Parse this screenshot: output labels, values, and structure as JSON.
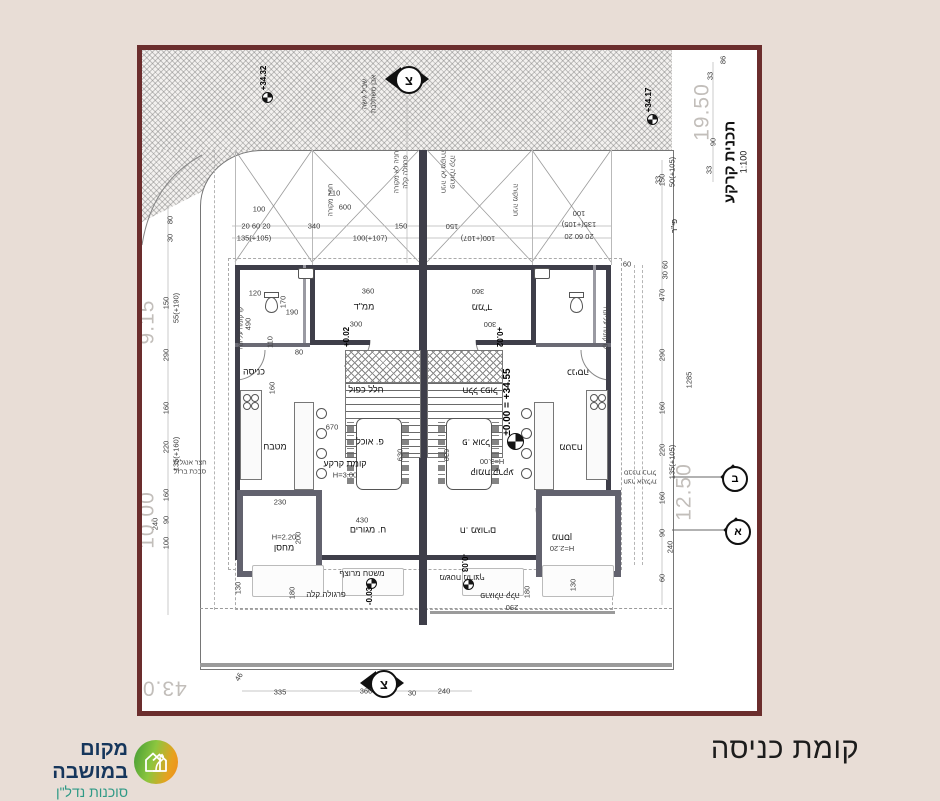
{
  "title": {
    "text": "קומת כניסה"
  },
  "logo": {
    "name": "מקום במושבה",
    "tagline": "סוכנות נדל\"ן",
    "colors": {
      "name": "#16365c",
      "tagline": "#2f9a86",
      "icon_green": "#8cc63f",
      "icon_orange": "#ee8c1e"
    }
  },
  "drawing": {
    "frame_color": "#6b2d2d",
    "plan_title": "תכנית קרקע",
    "plan_scale": "1:100",
    "north_letter": "צ",
    "section_marks": {
      "top": "ב",
      "bottom": "א"
    },
    "labels": [
      {
        "t": "+34.32",
        "x": 122,
        "y": 28,
        "r": -90,
        "c": "lvl"
      },
      {
        "t": "+34.17",
        "x": 507,
        "y": 50,
        "r": -90,
        "c": "lvl"
      },
      {
        "t": "שביל גישה",
        "x": 224,
        "y": 44,
        "r": -90,
        "c": "tiny"
      },
      {
        "t": "אבן משתלבת",
        "x": 233,
        "y": 44,
        "r": -90,
        "c": "tiny"
      },
      {
        "t": "19.50",
        "x": 560,
        "y": 62,
        "r": -90,
        "c": "big"
      },
      {
        "t": "86",
        "x": 581,
        "y": 10,
        "r": -90,
        "c": "dims"
      },
      {
        "t": "33",
        "x": 568,
        "y": 26,
        "r": -90,
        "c": "dims"
      },
      {
        "t": "90",
        "x": 571,
        "y": 92,
        "r": -90,
        "c": "dims"
      },
      {
        "t": "33",
        "x": 567,
        "y": 120,
        "r": -90,
        "c": "dims"
      },
      {
        "t": "33",
        "x": 516,
        "y": 130,
        "r": -90,
        "c": "dims"
      },
      {
        "t": "30 60",
        "x": 523,
        "y": 220,
        "r": -90,
        "c": "dims"
      },
      {
        "t": "פי\"ר",
        "x": 533,
        "y": 176,
        "r": -90,
        "c": "dim"
      },
      {
        "t": "חניה מקורה",
        "x": 190,
        "y": 150,
        "r": -90,
        "c": "tiny"
      },
      {
        "t": "חניה לא מקורה",
        "x": 256,
        "y": 122,
        "r": -90,
        "c": "tiny"
      },
      {
        "t": "פרגולה קלה",
        "x": 265,
        "y": 122,
        "r": -90,
        "c": "tiny"
      },
      {
        "t": "חניה לא מקורה",
        "x": 300,
        "y": 122,
        "r": 90,
        "c": "tiny"
      },
      {
        "t": "פרגולה קלה",
        "x": 309,
        "y": 122,
        "r": 90,
        "c": "tiny"
      },
      {
        "t": "חניה מקורה",
        "x": 372,
        "y": 150,
        "r": 90,
        "c": "tiny"
      },
      {
        "t": "710",
        "x": 192,
        "y": 143,
        "r": 0,
        "c": "dims"
      },
      {
        "t": "600",
        "x": 203,
        "y": 157,
        "r": 0,
        "c": "dims"
      },
      {
        "t": "340",
        "x": 172,
        "y": 176,
        "r": 0,
        "c": "dims"
      },
      {
        "t": "100",
        "x": 117,
        "y": 159,
        "r": 0,
        "c": "dims"
      },
      {
        "t": "20 60 20",
        "x": 114,
        "y": 176,
        "r": 0,
        "c": "dims"
      },
      {
        "t": "135(+105)",
        "x": 112,
        "y": 188,
        "r": 0,
        "c": "dims"
      },
      {
        "t": "100(+107)",
        "x": 228,
        "y": 188,
        "r": 0,
        "c": "dims"
      },
      {
        "t": "150",
        "x": 259,
        "y": 176,
        "r": 0,
        "c": "dims"
      },
      {
        "t": "150",
        "x": 310,
        "y": 176,
        "r": 180,
        "c": "dims"
      },
      {
        "t": "100(+107)",
        "x": 336,
        "y": 188,
        "r": 180,
        "c": "dims"
      },
      {
        "t": "100",
        "x": 437,
        "y": 163,
        "r": 180,
        "c": "dims"
      },
      {
        "t": "135(+105)",
        "x": 437,
        "y": 174,
        "r": 180,
        "c": "dims"
      },
      {
        "t": "20 60 20",
        "x": 437,
        "y": 186,
        "r": 180,
        "c": "dims"
      },
      {
        "t": "60",
        "x": 485,
        "y": 214,
        "r": 0,
        "c": "dims"
      },
      {
        "t": "150",
        "x": 520,
        "y": 130,
        "r": -90,
        "c": "dims"
      },
      {
        "t": "50(+105)",
        "x": 530,
        "y": 122,
        "r": -90,
        "c": "dims"
      },
      {
        "t": "470",
        "x": 520,
        "y": 245,
        "r": -90,
        "c": "dims"
      },
      {
        "t": "290",
        "x": 520,
        "y": 305,
        "r": -90,
        "c": "dims"
      },
      {
        "t": "160",
        "x": 520,
        "y": 358,
        "r": -90,
        "c": "dims"
      },
      {
        "t": "220",
        "x": 520,
        "y": 400,
        "r": -90,
        "c": "dims"
      },
      {
        "t": "135(+105)",
        "x": 530,
        "y": 412,
        "r": -90,
        "c": "dims"
      },
      {
        "t": "160",
        "x": 520,
        "y": 448,
        "r": -90,
        "c": "dims"
      },
      {
        "t": "90",
        "x": 520,
        "y": 483,
        "r": -90,
        "c": "dims"
      },
      {
        "t": "240",
        "x": 528,
        "y": 497,
        "r": -90,
        "c": "dims"
      },
      {
        "t": "60",
        "x": 520,
        "y": 528,
        "r": -90,
        "c": "dims"
      },
      {
        "t": "1285",
        "x": 547,
        "y": 330,
        "r": -90,
        "c": "dims"
      },
      {
        "t": "12.50",
        "x": 542,
        "y": 442,
        "r": -90,
        "c": "big"
      },
      {
        "t": "150",
        "x": 24,
        "y": 253,
        "r": -90,
        "c": "dims"
      },
      {
        "t": "55(+190)",
        "x": 34,
        "y": 258,
        "r": -90,
        "c": "dims"
      },
      {
        "t": "290",
        "x": 24,
        "y": 305,
        "r": -90,
        "c": "dims"
      },
      {
        "t": "160",
        "x": 24,
        "y": 358,
        "r": -90,
        "c": "dims"
      },
      {
        "t": "220",
        "x": 24,
        "y": 397,
        "r": -90,
        "c": "dims"
      },
      {
        "t": "135(+160)",
        "x": 34,
        "y": 404,
        "r": -90,
        "c": "dims"
      },
      {
        "t": "160",
        "x": 24,
        "y": 445,
        "r": -90,
        "c": "dims"
      },
      {
        "t": "90",
        "x": 24,
        "y": 470,
        "r": -90,
        "c": "dims"
      },
      {
        "t": "240",
        "x": 13,
        "y": 474,
        "r": -90,
        "c": "dims"
      },
      {
        "t": "100",
        "x": 24,
        "y": 493,
        "r": -90,
        "c": "dims"
      },
      {
        "t": "9.15",
        "x": 5,
        "y": 272,
        "r": -90,
        "c": "big"
      },
      {
        "t": "10.00",
        "x": 5,
        "y": 470,
        "r": -90,
        "c": "big"
      },
      {
        "t": "80",
        "x": 28,
        "y": 170,
        "r": -90,
        "c": "dims"
      },
      {
        "t": "30",
        "x": 28,
        "y": 188,
        "r": -90,
        "c": "dims"
      },
      {
        "t": "120",
        "x": 113,
        "y": 243,
        "r": 0,
        "c": "dims"
      },
      {
        "t": "490",
        "x": 106,
        "y": 274,
        "r": -90,
        "c": "dims"
      },
      {
        "t": "190",
        "x": 150,
        "y": 262,
        "r": 0,
        "c": "dims"
      },
      {
        "t": "170",
        "x": 141,
        "y": 252,
        "r": -90,
        "c": "dims"
      },
      {
        "t": "110",
        "x": 128,
        "y": 292,
        "r": -90,
        "c": "dims"
      },
      {
        "t": "160",
        "x": 130,
        "y": 338,
        "r": -90,
        "c": "dims"
      },
      {
        "t": "80",
        "x": 157,
        "y": 302,
        "r": 0,
        "c": "dims"
      },
      {
        "t": "360",
        "x": 226,
        "y": 241,
        "r": 0,
        "c": "dims"
      },
      {
        "t": "300",
        "x": 214,
        "y": 274,
        "r": 0,
        "c": "dims"
      },
      {
        "t": "360",
        "x": 336,
        "y": 241,
        "r": 180,
        "c": "dims"
      },
      {
        "t": "300",
        "x": 348,
        "y": 274,
        "r": 180,
        "c": "dims"
      },
      {
        "t": "ממ\"ד",
        "x": 222,
        "y": 257,
        "r": 0,
        "c": "room"
      },
      {
        "t": "ממ\"ד",
        "x": 340,
        "y": 257,
        "r": 180,
        "c": "room"
      },
      {
        "t": "+0.02",
        "x": 205,
        "y": 287,
        "r": -90,
        "c": "lvl"
      },
      {
        "t": "+0.02",
        "x": 357,
        "y": 287,
        "r": 90,
        "c": "lvl"
      },
      {
        "t": "כניסה",
        "x": 112,
        "y": 322,
        "r": 0,
        "c": "room"
      },
      {
        "t": "כניסה",
        "x": 436,
        "y": 322,
        "r": 180,
        "c": "room"
      },
      {
        "t": "קו קומה עליונה",
        "x": 100,
        "y": 278,
        "r": -90,
        "c": "tiny"
      },
      {
        "t": "קו קומה עליונה",
        "x": 462,
        "y": 278,
        "r": 90,
        "c": "tiny"
      },
      {
        "t": "חלל כפול",
        "x": 224,
        "y": 340,
        "r": 0,
        "c": "room"
      },
      {
        "t": "חלל כפול",
        "x": 338,
        "y": 340,
        "r": 180,
        "c": "room"
      },
      {
        "t": "פ. אוכל",
        "x": 228,
        "y": 392,
        "r": 0,
        "c": "room"
      },
      {
        "t": "פ. אוכל",
        "x": 334,
        "y": 392,
        "r": 180,
        "c": "room"
      },
      {
        "t": "670",
        "x": 190,
        "y": 377,
        "r": 0,
        "c": "dims"
      },
      {
        "t": "מטבח",
        "x": 133,
        "y": 397,
        "r": 0,
        "c": "room"
      },
      {
        "t": "מטבח",
        "x": 429,
        "y": 397,
        "r": 180,
        "c": "room"
      },
      {
        "t": "±0.00 = +34.55",
        "x": 366,
        "y": 352,
        "r": -90,
        "c": "lvl2"
      },
      {
        "t": "630",
        "x": 258,
        "y": 405,
        "r": -90,
        "c": "dims"
      },
      {
        "t": "630",
        "x": 304,
        "y": 405,
        "r": 90,
        "c": "dims"
      },
      {
        "t": "קומת קרקע",
        "x": 203,
        "y": 414,
        "r": 0,
        "c": "room"
      },
      {
        "t": "H=3.00",
        "x": 203,
        "y": 425,
        "r": 0,
        "c": "dims"
      },
      {
        "t": "קומת קרקע",
        "x": 350,
        "y": 422,
        "r": 180,
        "c": "room"
      },
      {
        "t": "H=3.00",
        "x": 350,
        "y": 411,
        "r": 180,
        "c": "dims"
      },
      {
        "t": "430",
        "x": 220,
        "y": 470,
        "r": 0,
        "c": "dims"
      },
      {
        "t": "ח. מגורים",
        "x": 226,
        "y": 480,
        "r": 0,
        "c": "room"
      },
      {
        "t": "ח. מגורים",
        "x": 336,
        "y": 480,
        "r": 180,
        "c": "room"
      },
      {
        "t": "230",
        "x": 138,
        "y": 452,
        "r": 0,
        "c": "dims"
      },
      {
        "t": "200",
        "x": 156,
        "y": 488,
        "r": -90,
        "c": "dims"
      },
      {
        "t": "H=2.20",
        "x": 142,
        "y": 487,
        "r": 0,
        "c": "dims"
      },
      {
        "t": "מחסן",
        "x": 142,
        "y": 498,
        "r": 0,
        "c": "room"
      },
      {
        "t": "H=2.20",
        "x": 420,
        "y": 498,
        "r": 180,
        "c": "dims"
      },
      {
        "t": "מחסן",
        "x": 420,
        "y": 487,
        "r": 180,
        "c": "room"
      },
      {
        "t": "חצר אנגלית",
        "x": 48,
        "y": 414,
        "r": 0,
        "c": "tiny"
      },
      {
        "t": "סבכת ברזל",
        "x": 48,
        "y": 423,
        "r": 0,
        "c": "tiny"
      },
      {
        "t": "חצר אנגלית",
        "x": 498,
        "y": 430,
        "r": 180,
        "c": "tiny"
      },
      {
        "t": "סבכת ברזל",
        "x": 498,
        "y": 421,
        "r": 180,
        "c": "tiny"
      },
      {
        "t": "130",
        "x": 96,
        "y": 538,
        "r": -90,
        "c": "dims"
      },
      {
        "t": "180",
        "x": 150,
        "y": 543,
        "r": -90,
        "c": "dims"
      },
      {
        "t": "130",
        "x": 431,
        "y": 535,
        "r": -90,
        "c": "dims"
      },
      {
        "t": "180",
        "x": 385,
        "y": 542,
        "r": -90,
        "c": "dims"
      },
      {
        "t": "290",
        "x": 370,
        "y": 557,
        "r": 180,
        "c": "dims"
      },
      {
        "t": "משטח מרוצף",
        "x": 220,
        "y": 524,
        "r": 0,
        "c": "dim"
      },
      {
        "t": "-0.03",
        "x": 228,
        "y": 546,
        "r": -90,
        "c": "lvl"
      },
      {
        "t": "משטח מרוצף",
        "x": 320,
        "y": 527,
        "r": 180,
        "c": "dim"
      },
      {
        "t": "-0.03",
        "x": 322,
        "y": 513,
        "r": 90,
        "c": "lvl"
      },
      {
        "t": "פרגולה קלה",
        "x": 184,
        "y": 545,
        "r": 0,
        "c": "dim"
      },
      {
        "t": "פרגולה קלה",
        "x": 358,
        "y": 545,
        "r": 180,
        "c": "dim"
      },
      {
        "t": "335",
        "x": 138,
        "y": 642,
        "r": 0,
        "c": "dims"
      },
      {
        "t": "360",
        "x": 224,
        "y": 641,
        "r": 0,
        "c": "dims"
      },
      {
        "t": "30",
        "x": 270,
        "y": 643,
        "r": 0,
        "c": "dims"
      },
      {
        "t": "240",
        "x": 302,
        "y": 641,
        "r": 0,
        "c": "dims"
      },
      {
        "t": "43.00",
        "x": 16,
        "y": 638,
        "r": 180,
        "c": "big"
      },
      {
        "t": "46",
        "x": 97,
        "y": 627,
        "r": -60,
        "c": "dims"
      }
    ]
  }
}
